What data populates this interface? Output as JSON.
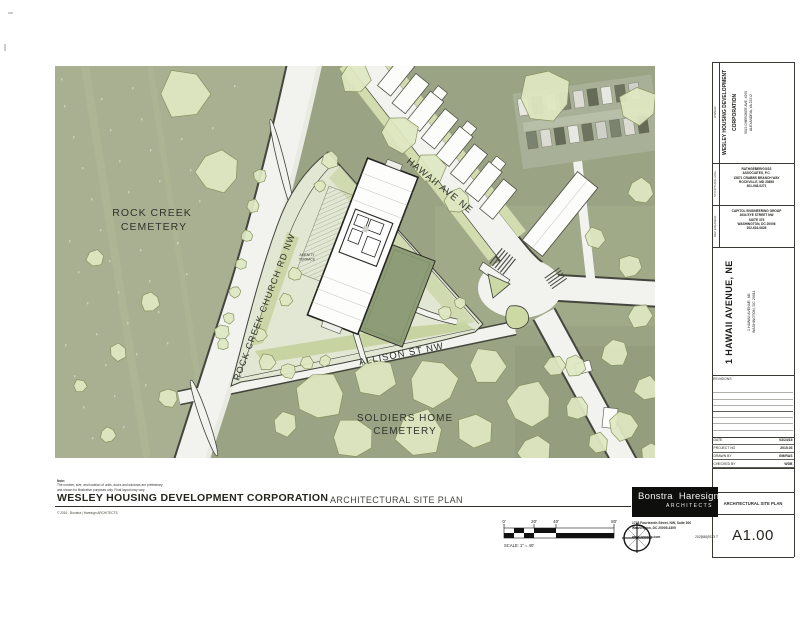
{
  "sheet": {
    "note_title": "Note:",
    "note_line1": "The number, size, and location of units, doors and windows are preliminary",
    "note_line2": "and shown for illustrative purposes only. Final layout may vary.",
    "project_title": "WESLEY HOUSING  DEVELOPMENT CORPORATION",
    "drawing_title": "ARCHITECTURAL SITE PLAN",
    "copyright": "© 2016 - Bonstra | Haresign ARCHITECTS",
    "scale": {
      "t0": "0'",
      "t20": "20'",
      "t40": "40'",
      "t80": "80'",
      "label": "SCALE: 1\" = 40'"
    }
  },
  "map": {
    "rock_creek_cemetery_line1": "ROCK CREEK",
    "rock_creek_cemetery_line2": "CEMETERY",
    "church_rd": "ROCK CREEK CHURCH RD NW",
    "hawaii_ave": "HAWAII AVE NE",
    "allison_st": "ALLISON ST NW",
    "soldiers_line1": "SOLDIERS HOME",
    "soldiers_line2": "CEMETERY",
    "amenity_line1": "AMENITY",
    "amenity_line2": "TERRACE"
  },
  "titleblock": {
    "owner_label": "OWNER",
    "owner_name_line1": "WESLEY HOUSING DEVELOPMENT",
    "owner_name_line2": "CORPORATION",
    "owner_addr_line1": "5515 CHEROKEE AVE, #200",
    "owner_addr_line2": "ALEXANDRIA, VA 22312",
    "structural_label": "STRUCTURAL ENG.",
    "structural_lines": [
      "RATHGEBER/GOSS",
      "ASSOCIATES, P.C.",
      "15871 CRABBS BRANCH WAY",
      "ROCKVILLE, MD 20855",
      "301-948-0271"
    ],
    "mep_label": "MEP ENGINEER",
    "mep_lines": [
      "CAPITOL ENGINEERING GROUP",
      "1634 EYE STREET NW",
      "SUITE 375",
      "WASHINGTON, DC 20006",
      "202-616-0628"
    ],
    "project_name": "1 HAWAII AVENUE, NE",
    "project_addr_line1": "1 HAWAII AVENUE, NE",
    "project_addr_line2": "WASHINGTON, DC 20011",
    "revisions_label": "REVISIONS",
    "fields": [
      {
        "label": "DATE",
        "value": "03/24/16"
      },
      {
        "label": "PROJECT NO",
        "value": "2015.03"
      },
      {
        "label": "DRAWN BY",
        "value": "GM/RAS"
      },
      {
        "label": "CHECKED BY",
        "value": "WDB"
      }
    ],
    "sheet_title": "ARCHITECTURAL SITE PLAN",
    "sheet_number": "A1.00"
  },
  "firm": {
    "name_left": "Bonstra",
    "name_right": "Haresign",
    "subtitle": "ARCHITECTS",
    "addr_line1": "1728 Fourteenth Street, NW, Suite 300",
    "addr_line2": "Washington, DC 20009-4309",
    "web": "www.bonstra.com",
    "phone": "202|588|9373 T"
  },
  "colors": {
    "tree_fill": "#dfe7c2",
    "cemetery_green": "#a8b091",
    "aerial_green": "#9aa383",
    "road_white": "#f2f3ef",
    "roof_green": "#8e9c78",
    "ink": "#23231f"
  }
}
